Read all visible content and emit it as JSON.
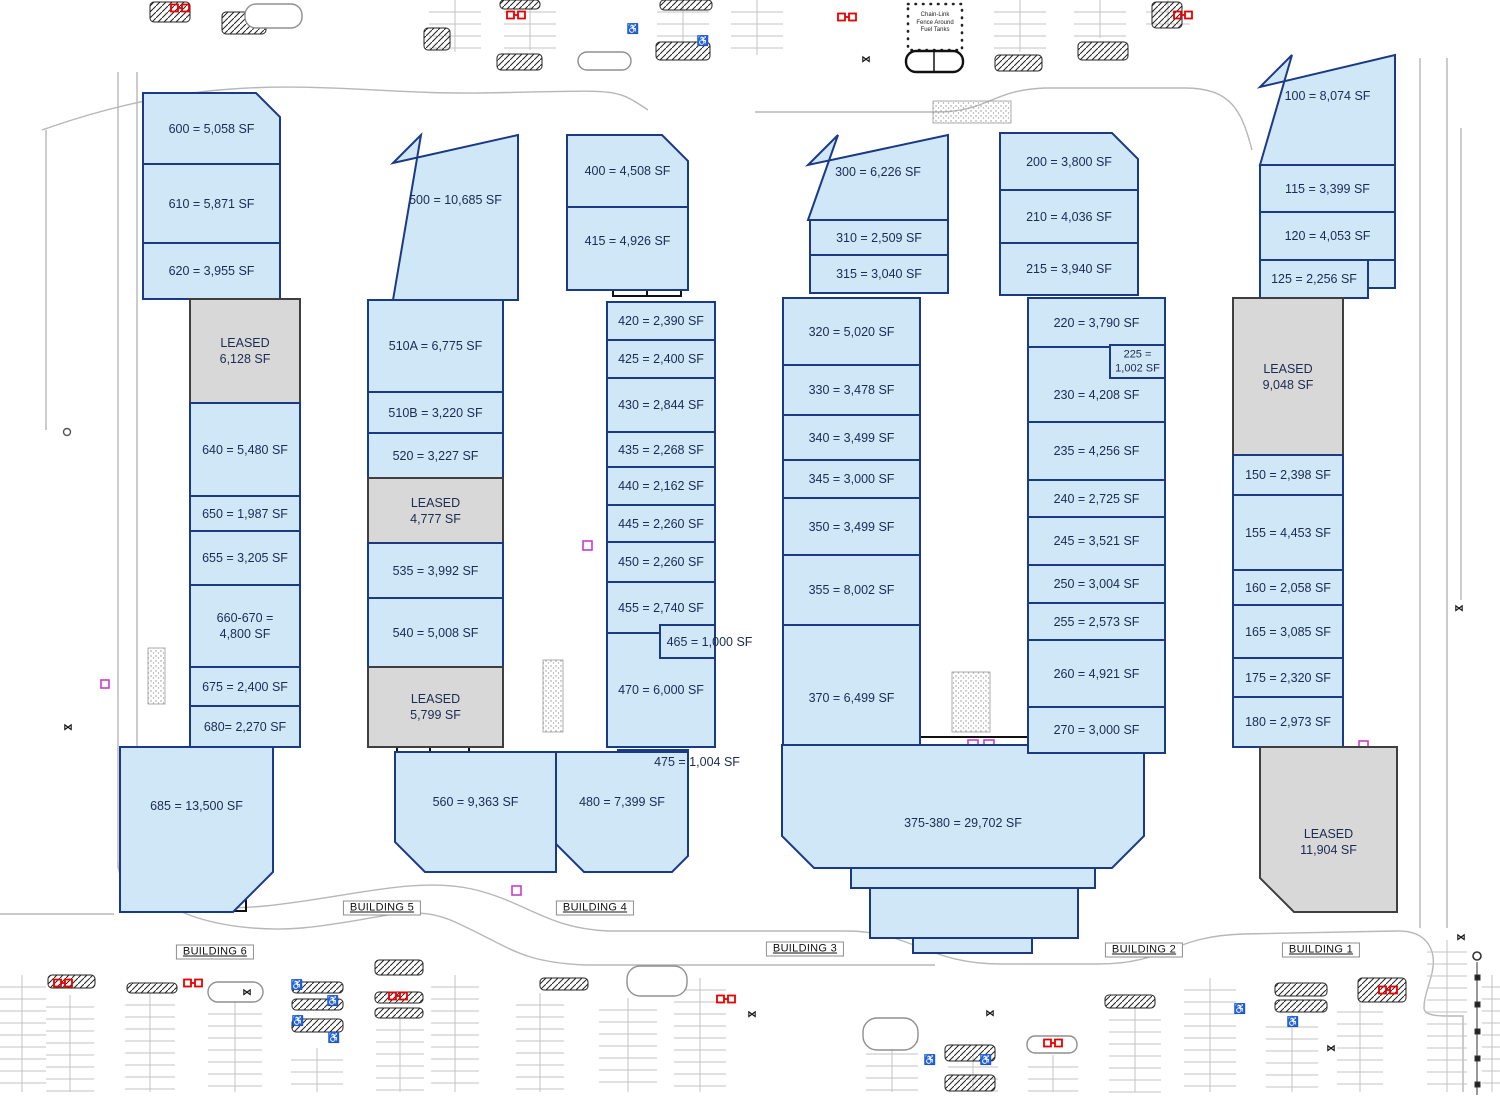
{
  "site": {
    "fuel_note": [
      "Chain-Link",
      "Fence Around",
      "Fuel Tanks"
    ]
  },
  "colors": {
    "unit_fill": "#d0e7f8",
    "leased_fill": "#d8d8d8",
    "unit_stroke": "#1b3a85",
    "leased_stroke": "#3f3f3f",
    "text": "#1c2b52",
    "road": "#b7b7b7",
    "marker_red": "#e80000"
  },
  "buildings": [
    {
      "name": "BUILDING 6",
      "label_x": 215,
      "label_y": 952,
      "units": [
        {
          "id": "600",
          "label": "600 = 5,058 SF",
          "x": 143,
          "y": 93,
          "w": 137,
          "h": 71,
          "cut": {
            "tr": 24
          }
        },
        {
          "id": "610",
          "label": "610 = 5,871 SF",
          "x": 143,
          "y": 164,
          "w": 137,
          "h": 79
        },
        {
          "id": "620",
          "label": "620 = 3,955 SF",
          "x": 143,
          "y": 243,
          "w": 137,
          "h": 56
        },
        {
          "id": "L-6128",
          "label": "LEASED\n6,128 SF",
          "leased": true,
          "x": 190,
          "y": 299,
          "w": 110,
          "h": 104
        },
        {
          "id": "640",
          "label": "640 = 5,480 SF",
          "x": 190,
          "y": 403,
          "w": 110,
          "h": 93
        },
        {
          "id": "650",
          "label": "650 = 1,987 SF",
          "x": 190,
          "y": 496,
          "w": 110,
          "h": 35
        },
        {
          "id": "655",
          "label": "655 = 3,205 SF",
          "x": 190,
          "y": 531,
          "w": 110,
          "h": 54
        },
        {
          "id": "660-670",
          "label": "660-670 =\n4,800 SF",
          "x": 190,
          "y": 585,
          "w": 110,
          "h": 82
        },
        {
          "id": "675",
          "label": "675 = 2,400 SF",
          "x": 190,
          "y": 667,
          "w": 110,
          "h": 39
        },
        {
          "id": "680",
          "label": "680= 2,270 SF",
          "x": 190,
          "y": 706,
          "w": 110,
          "h": 41
        },
        {
          "id": "685",
          "label": "685 = 13,500 SF",
          "x": 120,
          "y": 747,
          "w": 153,
          "h": 165,
          "cut": {
            "br": 40
          },
          "dy": -24
        }
      ]
    },
    {
      "name": "BUILDING 5",
      "label_x": 382,
      "label_y": 908,
      "units": [
        {
          "id": "500",
          "label": "500 = 10,685 SF",
          "x": 393,
          "y": 135,
          "w": 125,
          "h": 165,
          "cut": {
            "tl": 28
          },
          "dy": -18
        },
        {
          "id": "510A",
          "label": "510A = 6,775 SF",
          "x": 368,
          "y": 300,
          "w": 135,
          "h": 92
        },
        {
          "id": "510B",
          "label": "510B = 3,220 SF",
          "x": 368,
          "y": 392,
          "w": 135,
          "h": 41
        },
        {
          "id": "520",
          "label": "520 = 3,227 SF",
          "x": 368,
          "y": 433,
          "w": 135,
          "h": 45
        },
        {
          "id": "L-4777",
          "label": "LEASED\n4,777 SF",
          "leased": true,
          "x": 368,
          "y": 478,
          "w": 135,
          "h": 65
        },
        {
          "id": "535",
          "label": "535 = 3,992 SF",
          "x": 368,
          "y": 543,
          "w": 135,
          "h": 55
        },
        {
          "id": "540",
          "label": "540 = 5,008 SF",
          "x": 368,
          "y": 598,
          "w": 135,
          "h": 69
        },
        {
          "id": "L-5799",
          "label": "LEASED\n5,799 SF",
          "leased": true,
          "x": 368,
          "y": 667,
          "w": 135,
          "h": 80
        },
        {
          "id": "560",
          "label": "560 = 9,363 SF",
          "x": 395,
          "y": 752,
          "w": 161,
          "h": 120,
          "cut": {
            "bl": 30
          },
          "dy": -10
        }
      ]
    },
    {
      "name": "BUILDING 4",
      "label_x": 595,
      "label_y": 908,
      "units": [
        {
          "id": "400",
          "label": "400 = 4,508 SF",
          "x": 567,
          "y": 135,
          "w": 121,
          "h": 72,
          "cut": {
            "tr": 26
          }
        },
        {
          "id": "415",
          "label": "415 = 4,926 SF",
          "x": 567,
          "y": 207,
          "w": 121,
          "h": 83,
          "dy": -8
        },
        {
          "id": "420",
          "label": "420 = 2,390 SF",
          "x": 607,
          "y": 302,
          "w": 108,
          "h": 38
        },
        {
          "id": "425",
          "label": "425 = 2,400 SF",
          "x": 607,
          "y": 340,
          "w": 108,
          "h": 38
        },
        {
          "id": "430",
          "label": "430 = 2,844 SF",
          "x": 607,
          "y": 378,
          "w": 108,
          "h": 54
        },
        {
          "id": "435",
          "label": "435 = 2,268 SF",
          "x": 607,
          "y": 432,
          "w": 108,
          "h": 35
        },
        {
          "id": "440",
          "label": "440 = 2,162 SF",
          "x": 607,
          "y": 467,
          "w": 108,
          "h": 38
        },
        {
          "id": "445",
          "label": "445 = 2,260 SF",
          "x": 607,
          "y": 505,
          "w": 108,
          "h": 37
        },
        {
          "id": "450",
          "label": "450 = 2,260 SF",
          "x": 607,
          "y": 542,
          "w": 108,
          "h": 40
        },
        {
          "id": "455",
          "label": "455 = 2,740 SF",
          "x": 607,
          "y": 582,
          "w": 108,
          "h": 51
        },
        {
          "id": "470",
          "label": "470 = 6,000 SF",
          "x": 607,
          "y": 633,
          "w": 108,
          "h": 114
        },
        {
          "id": "465",
          "label": "465 = 1,000 SF",
          "x": 660,
          "y": 625,
          "w": 55,
          "h": 33,
          "nowrap": true,
          "dx": 22
        },
        {
          "id": "475",
          "label": "475 = 1,004 SF",
          "x": 618,
          "y": 750,
          "w": 70,
          "h": 26,
          "nowrap": true,
          "dx": 44,
          "dy": -1
        },
        {
          "id": "480",
          "label": "480 = 7,399 SF",
          "x": 556,
          "y": 752,
          "w": 132,
          "h": 120,
          "cut": {
            "bl": 28,
            "br": 16
          },
          "dy": -10
        }
      ]
    },
    {
      "name": "BUILDING 3",
      "label_x": 805,
      "label_y": 949,
      "units": [
        {
          "id": "300",
          "label": "300 = 6,226 SF",
          "x": 808,
          "y": 135,
          "w": 140,
          "h": 85,
          "cut": {
            "tl": 30
          },
          "dy": -6
        },
        {
          "id": "310",
          "label": "310 = 2,509 SF",
          "x": 810,
          "y": 220,
          "w": 138,
          "h": 35
        },
        {
          "id": "315",
          "label": "315 = 3,040 SF",
          "x": 810,
          "y": 255,
          "w": 138,
          "h": 38
        },
        {
          "id": "320",
          "label": "320 = 5,020 SF",
          "x": 783,
          "y": 298,
          "w": 137,
          "h": 67
        },
        {
          "id": "330",
          "label": "330 = 3,478 SF",
          "x": 783,
          "y": 365,
          "w": 137,
          "h": 50
        },
        {
          "id": "340",
          "label": "340 = 3,499 SF",
          "x": 783,
          "y": 415,
          "w": 137,
          "h": 45
        },
        {
          "id": "345",
          "label": "345 = 3,000 SF",
          "x": 783,
          "y": 460,
          "w": 137,
          "h": 38
        },
        {
          "id": "350",
          "label": "350 = 3,499 SF",
          "x": 783,
          "y": 498,
          "w": 137,
          "h": 57
        },
        {
          "id": "355",
          "label": "355 = 8,002 SF",
          "x": 783,
          "y": 555,
          "w": 137,
          "h": 70
        },
        {
          "id": "370",
          "label": "370 = 6,499 SF",
          "x": 783,
          "y": 625,
          "w": 137,
          "h": 120,
          "dy": 13
        },
        {
          "id": "375-380",
          "label": "375-380 = 29,702 SF",
          "x": 782,
          "y": 745,
          "w": 362,
          "h": 123,
          "cut": {
            "bl": 32,
            "br": 32
          },
          "dy": 16
        }
      ]
    },
    {
      "name": "BUILDING 2",
      "label_x": 1144,
      "label_y": 950,
      "units": [
        {
          "id": "200",
          "label": "200 = 3,800 SF",
          "x": 1000,
          "y": 133,
          "w": 138,
          "h": 57,
          "cut": {
            "tr": 26
          }
        },
        {
          "id": "210",
          "label": "210 = 4,036 SF",
          "x": 1000,
          "y": 190,
          "w": 138,
          "h": 53
        },
        {
          "id": "215",
          "label": "215 = 3,940 SF",
          "x": 1000,
          "y": 243,
          "w": 138,
          "h": 52
        },
        {
          "id": "220",
          "label": "220 = 3,790 SF",
          "x": 1028,
          "y": 298,
          "w": 137,
          "h": 49
        },
        {
          "id": "230",
          "label": "230 = 4,208 SF",
          "x": 1028,
          "y": 347,
          "w": 137,
          "h": 75,
          "dy": 10
        },
        {
          "id": "225",
          "label": "225 =\n1,002 SF",
          "x": 1110,
          "y": 345,
          "w": 55,
          "h": 33,
          "small": true
        },
        {
          "id": "235",
          "label": "235 = 4,256 SF",
          "x": 1028,
          "y": 422,
          "w": 137,
          "h": 58
        },
        {
          "id": "240",
          "label": "240 = 2,725 SF",
          "x": 1028,
          "y": 480,
          "w": 137,
          "h": 37
        },
        {
          "id": "245",
          "label": "245 = 3,521 SF",
          "x": 1028,
          "y": 517,
          "w": 137,
          "h": 48
        },
        {
          "id": "250",
          "label": "250 = 3,004 SF",
          "x": 1028,
          "y": 565,
          "w": 137,
          "h": 38
        },
        {
          "id": "255",
          "label": "255 = 2,573 SF",
          "x": 1028,
          "y": 603,
          "w": 137,
          "h": 37
        },
        {
          "id": "260",
          "label": "260 = 4,921 SF",
          "x": 1028,
          "y": 640,
          "w": 137,
          "h": 67
        },
        {
          "id": "270",
          "label": "270 = 3,000 SF",
          "x": 1028,
          "y": 707,
          "w": 137,
          "h": 46
        }
      ]
    },
    {
      "name": "BUILDING 1",
      "label_x": 1321,
      "label_y": 950,
      "units": [
        {
          "id": "100",
          "label": "100 = 8,074 SF",
          "x": 1260,
          "y": 55,
          "w": 135,
          "h": 110,
          "cut": {
            "tl": 32
          },
          "dy": -14
        },
        {
          "id": "115",
          "label": "115 = 3,399 SF",
          "x": 1260,
          "y": 165,
          "w": 135,
          "h": 47
        },
        {
          "id": "120",
          "label": "120 = 4,053 SF",
          "x": 1260,
          "y": 212,
          "w": 135,
          "h": 48
        },
        {
          "id": "125",
          "label": "125 = 2,256 SF",
          "x": 1260,
          "y": 260,
          "w": 108,
          "h": 38
        },
        {
          "id": "L-9048",
          "label": "LEASED\n9,048 SF",
          "leased": true,
          "x": 1233,
          "y": 298,
          "w": 110,
          "h": 157
        },
        {
          "id": "150",
          "label": "150 = 2,398 SF",
          "x": 1233,
          "y": 455,
          "w": 110,
          "h": 40
        },
        {
          "id": "155",
          "label": "155 = 4,453 SF",
          "x": 1233,
          "y": 495,
          "w": 110,
          "h": 75
        },
        {
          "id": "160",
          "label": "160 = 2,058 SF",
          "x": 1233,
          "y": 570,
          "w": 110,
          "h": 35
        },
        {
          "id": "165",
          "label": "165 = 3,085 SF",
          "x": 1233,
          "y": 605,
          "w": 110,
          "h": 53
        },
        {
          "id": "175",
          "label": "175 = 2,320 SF",
          "x": 1233,
          "y": 658,
          "w": 110,
          "h": 39
        },
        {
          "id": "180",
          "label": "180 = 2,973 SF",
          "x": 1233,
          "y": 697,
          "w": 110,
          "h": 50
        },
        {
          "id": "L-11904",
          "label": "LEASED\n11,904 SF",
          "leased": true,
          "x": 1260,
          "y": 747,
          "w": 137,
          "h": 165,
          "cut": {
            "bl": 34
          },
          "dy": 12
        }
      ]
    }
  ],
  "shapes": [
    {
      "id": "375-step1",
      "x": 851,
      "y": 868,
      "w": 244,
      "h": 20
    },
    {
      "id": "375-step2",
      "x": 870,
      "y": 888,
      "w": 208,
      "h": 50
    },
    {
      "id": "375-step3",
      "x": 913,
      "y": 938,
      "w": 119,
      "h": 15
    },
    {
      "id": "120-sliver",
      "x": 1368,
      "y": 260,
      "w": 27,
      "h": 28
    }
  ]
}
